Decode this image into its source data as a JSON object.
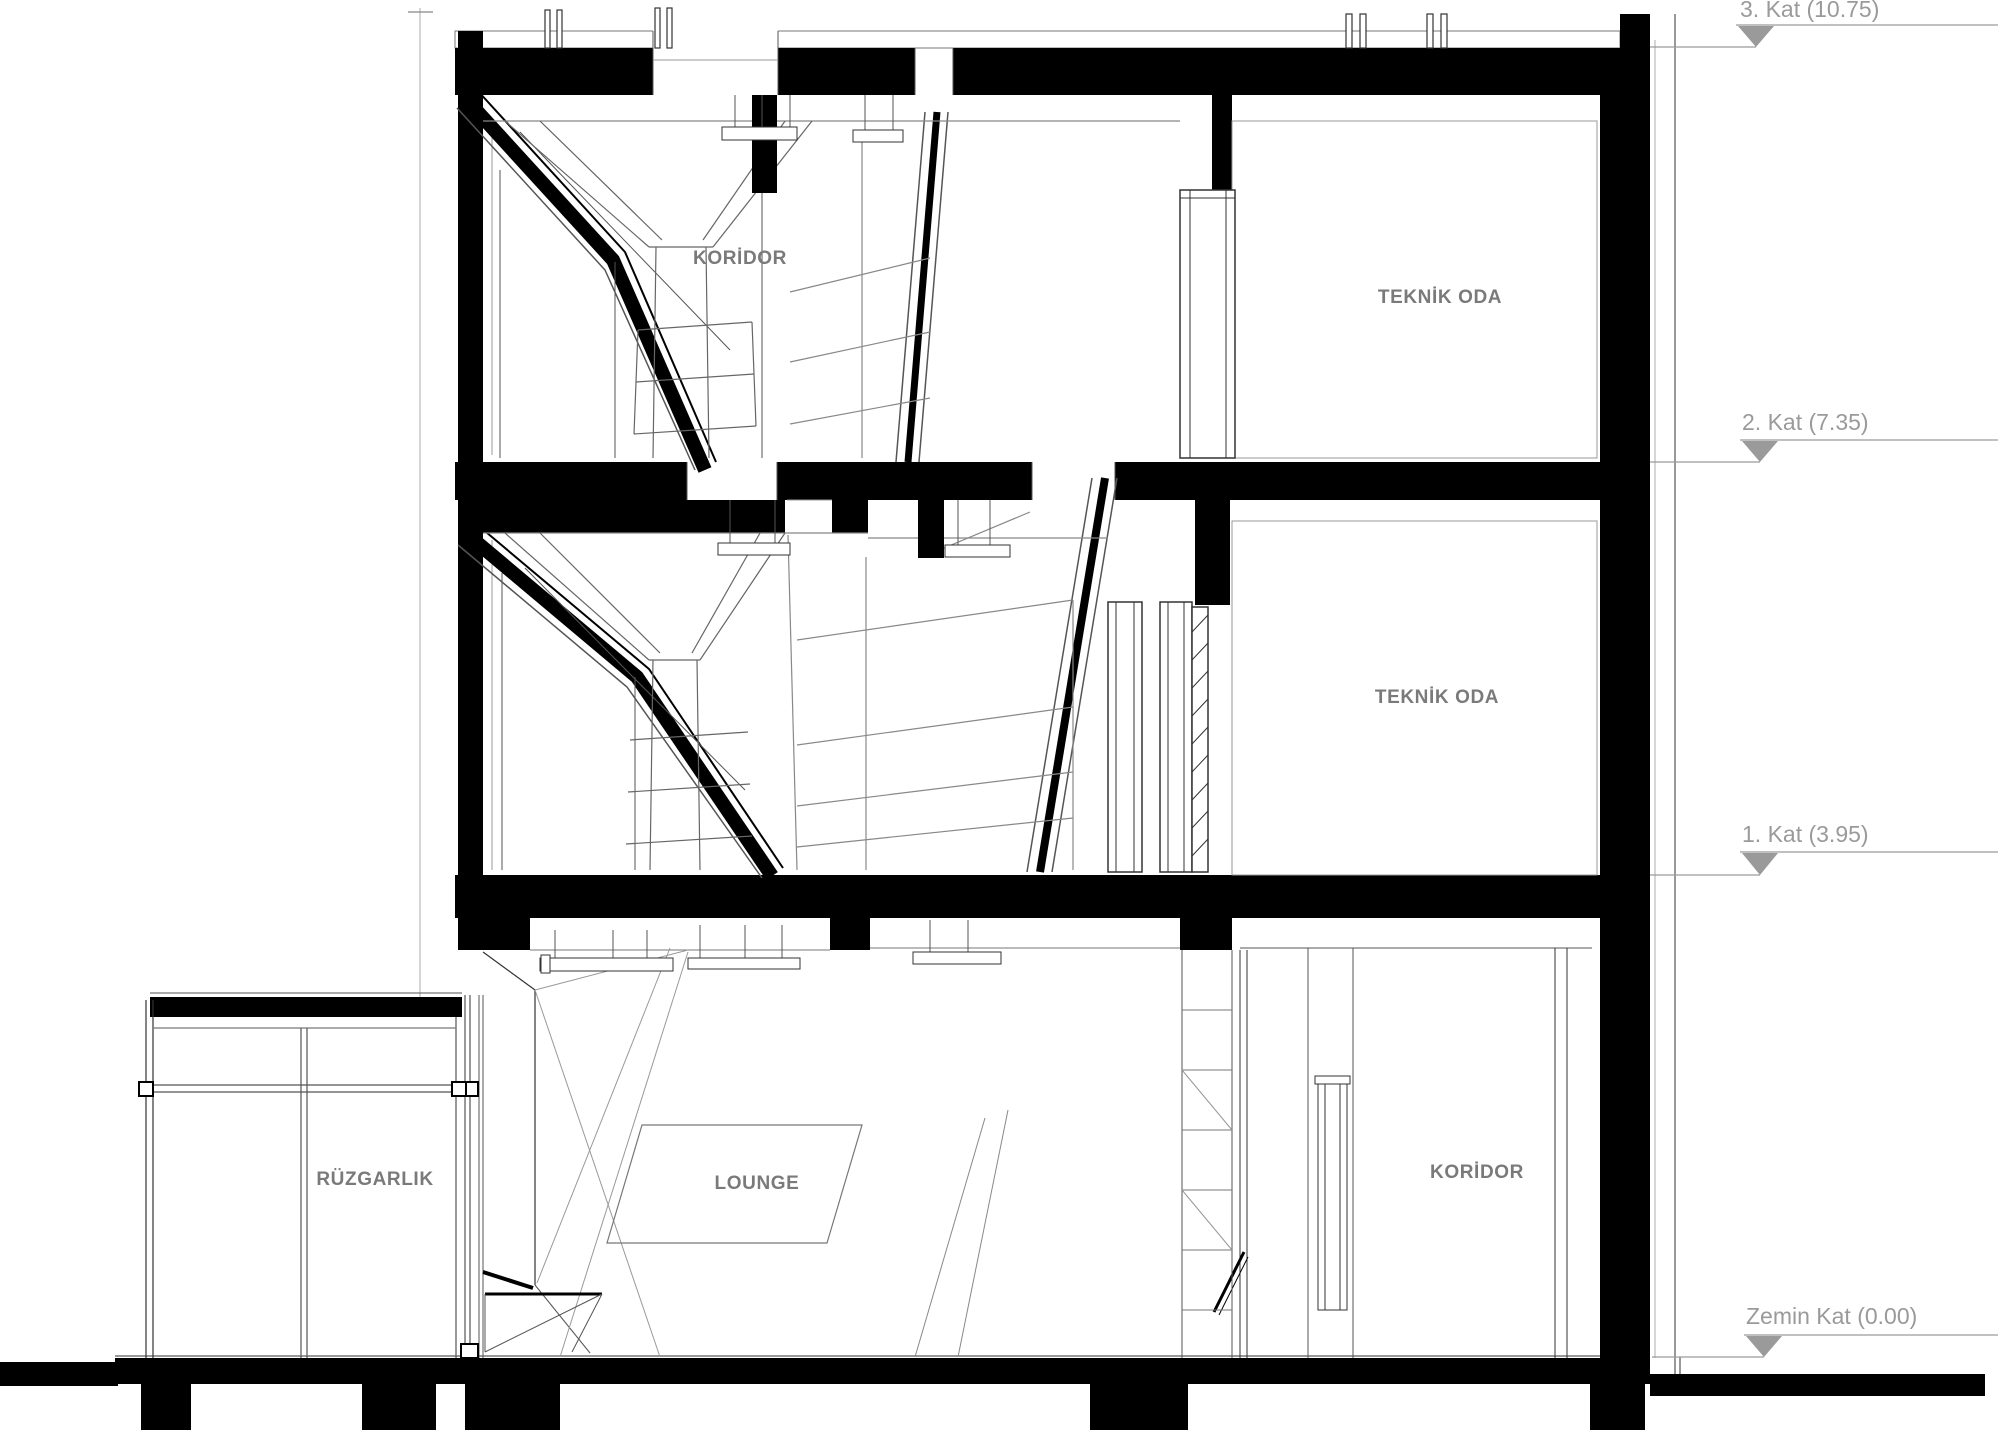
{
  "drawing": {
    "levels": [
      {
        "label": "3. Kat (10.75)"
      },
      {
        "label": "2. Kat (7.35)"
      },
      {
        "label": "1. Kat (3.95)"
      },
      {
        "label": "Zemin Kat (0.00)"
      }
    ],
    "rooms": [
      {
        "label": "KORİDOR"
      },
      {
        "label": "TEKNİK ODA"
      },
      {
        "label": "TEKNİK ODA"
      },
      {
        "label": "RÜZGARLIK"
      },
      {
        "label": "LOUNGE"
      },
      {
        "label": "KORİDOR"
      }
    ],
    "colors": {
      "background": "#ffffff",
      "section_cut": "#000000",
      "annotation": "#9a9a9a",
      "room_label": "#7a7a7a"
    }
  }
}
